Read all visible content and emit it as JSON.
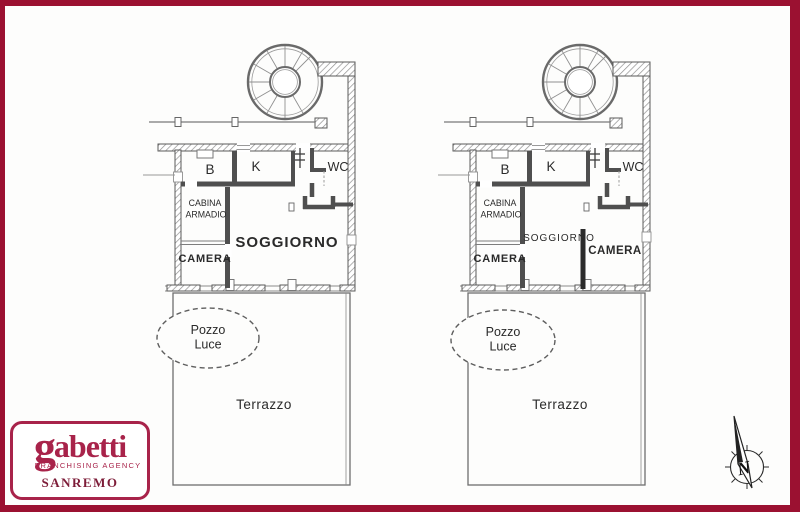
{
  "frame": {
    "color": "#9b1131"
  },
  "logo": {
    "brand_initial": "g",
    "brand_rest": "abetti",
    "subtitle": "FRANCHISING AGENCY",
    "city": "SANREMO",
    "accent_color": "#a8234a",
    "city_color": "#7d1c38"
  },
  "compass": {
    "north_label": "N"
  },
  "plans": [
    {
      "title": "floor-plan-left",
      "rooms": {
        "bath": "B",
        "kitchen": "K",
        "wc": "WC",
        "closet_line1": "CABINA",
        "closet_line2": "ARMADIO",
        "bedroom": "CAMERA",
        "living": "SOGGIORNO",
        "lightwell_line1": "Pozzo",
        "lightwell_line2": "Luce",
        "terrace": "Terrazzo"
      }
    },
    {
      "title": "floor-plan-right",
      "rooms": {
        "bath": "B",
        "kitchen": "K",
        "wc": "WC",
        "closet_line1": "CABINA",
        "closet_line2": "ARMADIO",
        "bedroom": "CAMERA",
        "living": "SOGGIORNO",
        "bedroom2": "CAMERA",
        "lightwell_line1": "Pozzo",
        "lightwell_line2": "Luce",
        "terrace": "Terrazzo"
      }
    }
  ]
}
